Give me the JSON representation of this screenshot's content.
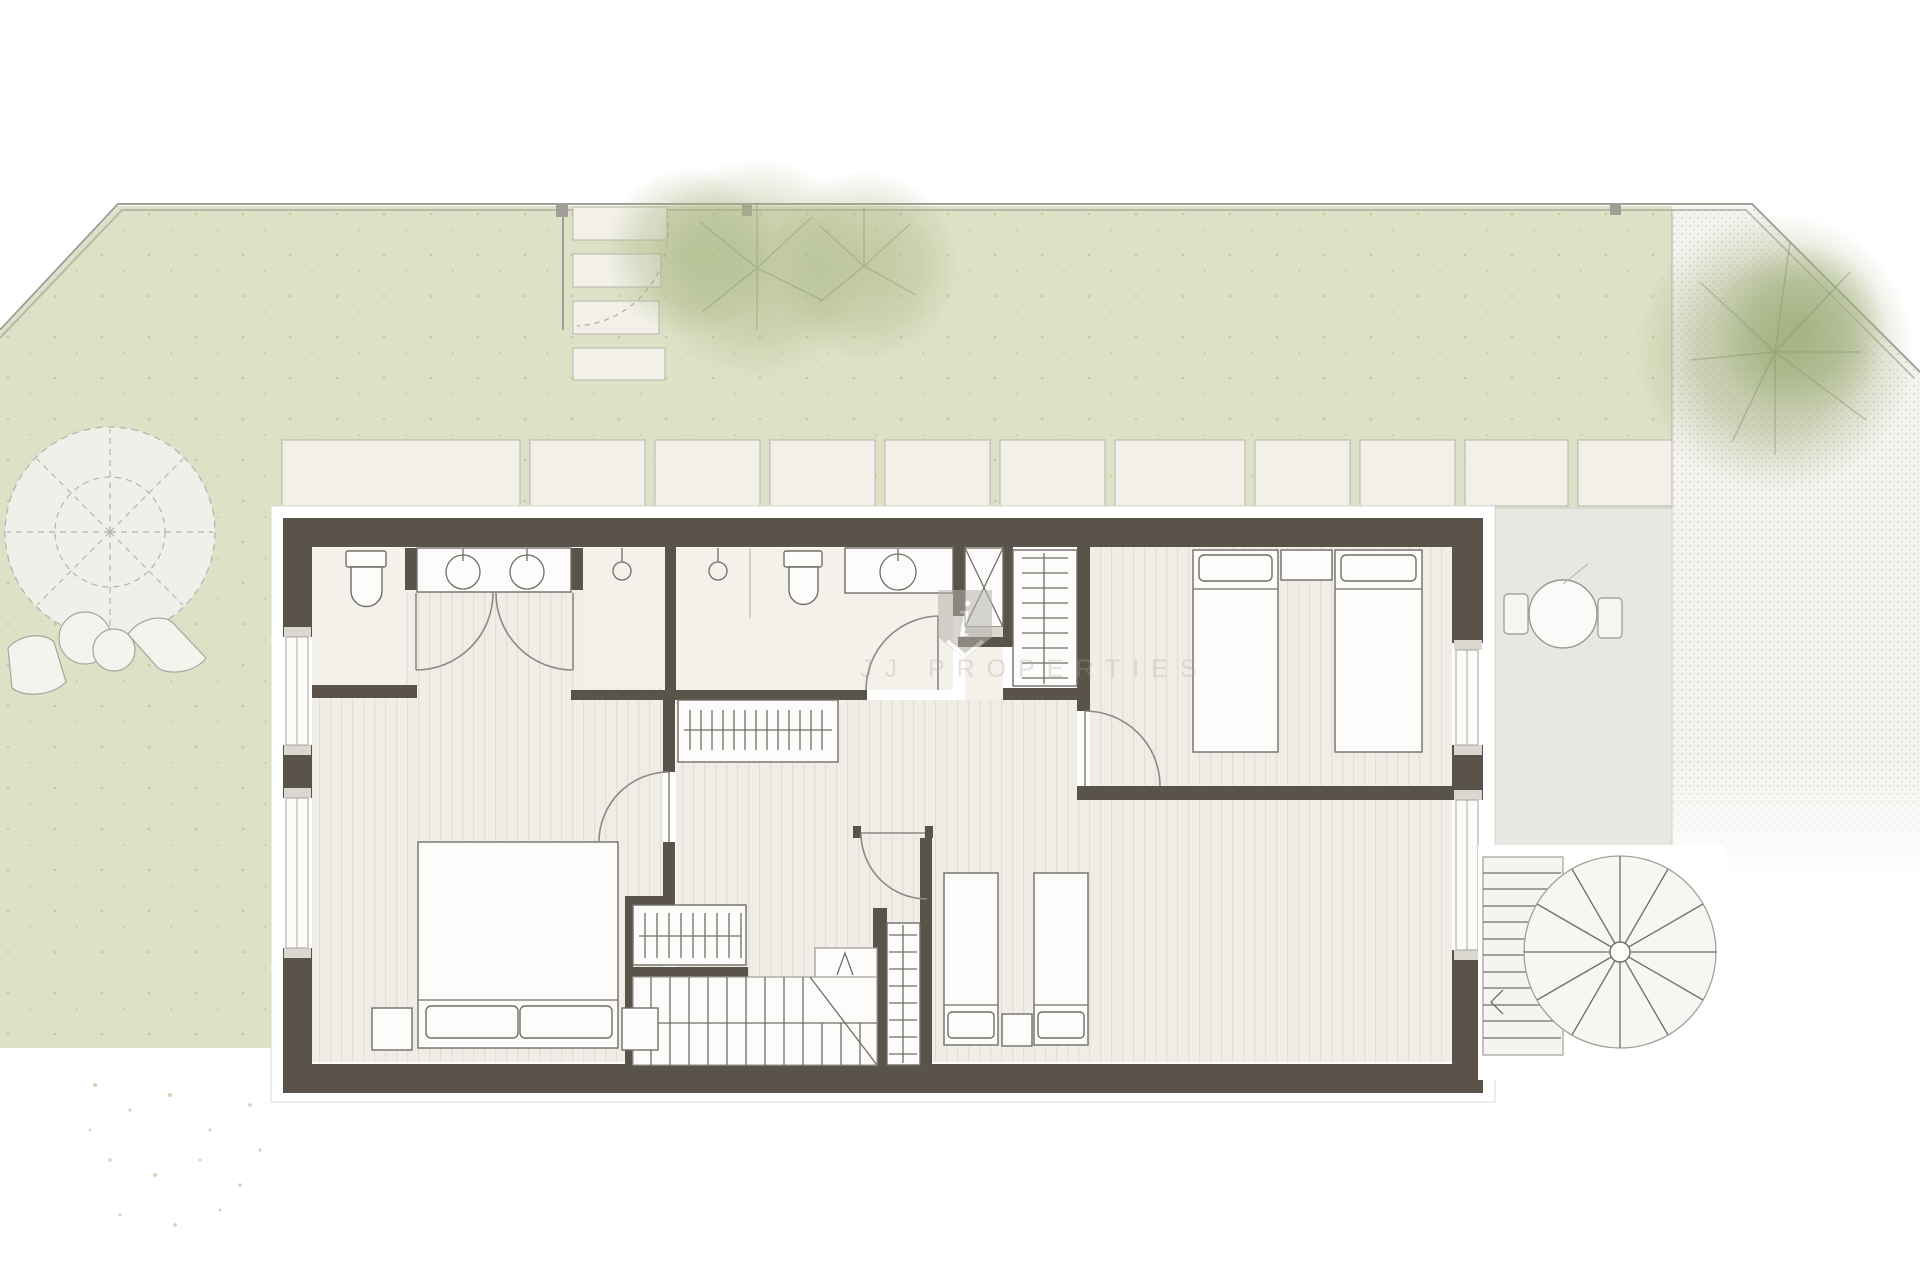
{
  "watermark": {
    "badge_letter": "i",
    "label": "JJ PROPERTIES"
  },
  "colors": {
    "wall": "#59534a",
    "garden": "#dde1c6",
    "grass-dot": "#bcc49b",
    "paving": "#f2f0e9",
    "paving-line": "#b8b6ad",
    "terrace": "#e9e7e1",
    "gravel-base": "#f4f3ef",
    "gravel-dot": "#c9c7c0",
    "floor-base": "#efede6",
    "floor-line": "#e0ded5",
    "bath": "#f3f1ea",
    "outline": "#6f6e68",
    "boundary": "#a09e96",
    "tree": "#a9b684",
    "tree-line": "#88946a",
    "watermark": "#a8a69e"
  }
}
